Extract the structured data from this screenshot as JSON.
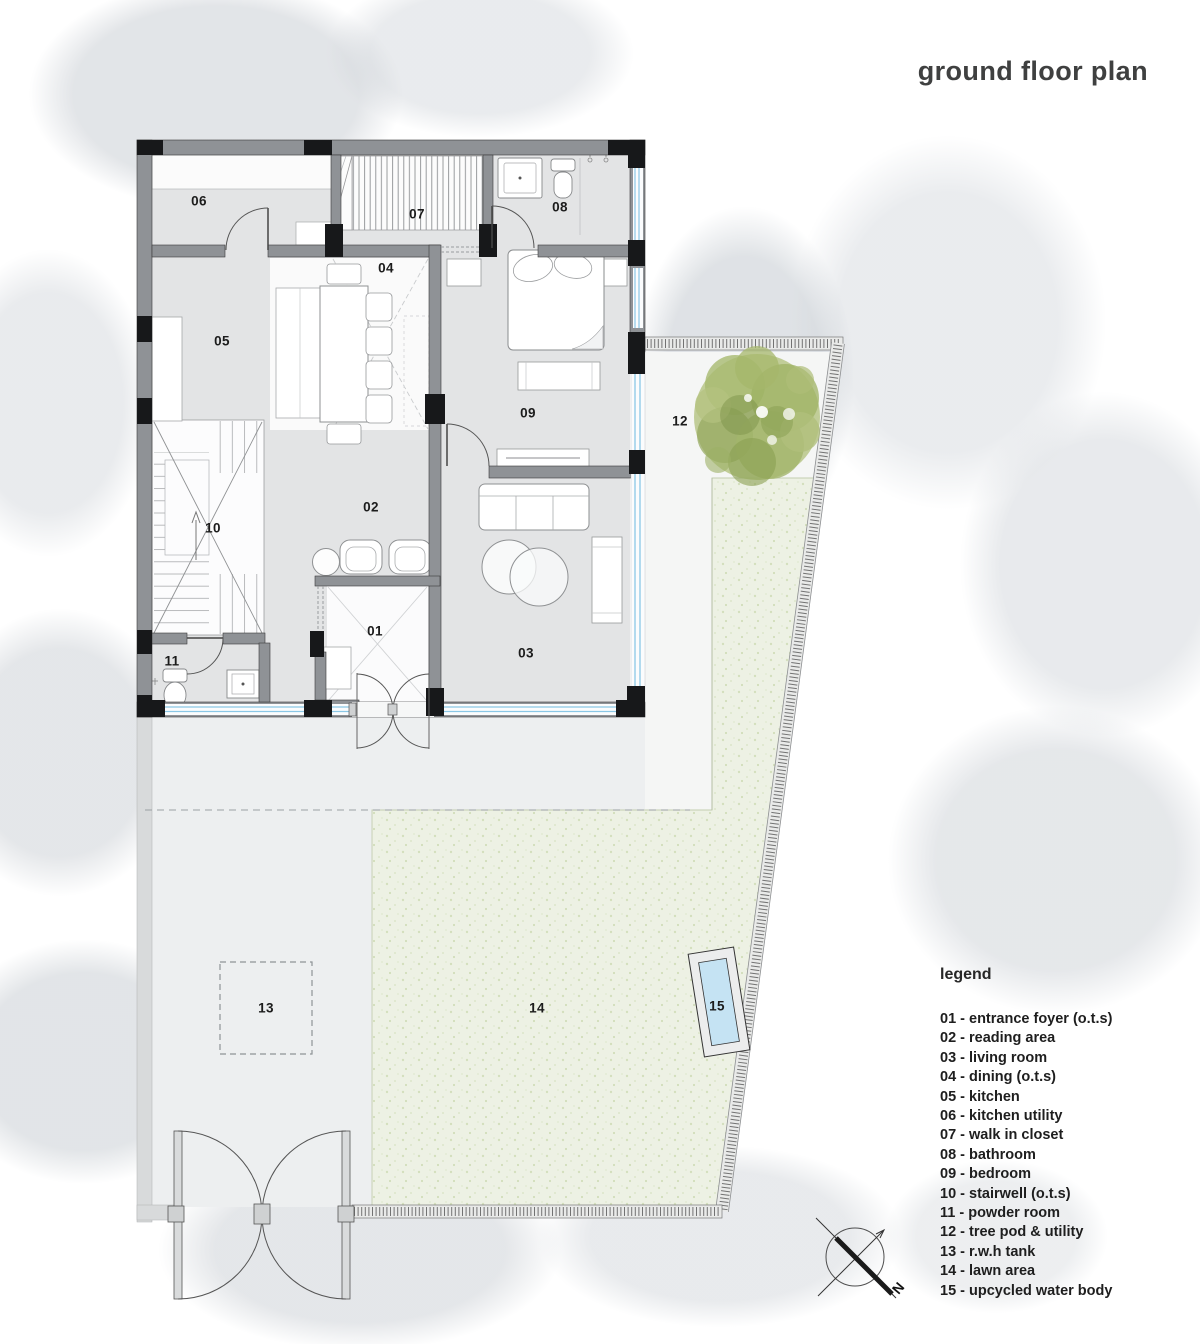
{
  "title": "ground floor plan",
  "legend": {
    "title": "legend",
    "items": [
      "01 - entrance foyer (o.t.s)",
      "02 - reading area",
      "03 - living room",
      "04 - dining (o.t.s)",
      "05 - kitchen",
      "06 - kitchen utility",
      "07 - walk in closet",
      "08 - bathroom",
      "09 - bedroom",
      "10 - stairwell (o.t.s)",
      "11 - powder room",
      "12 - tree pod & utility",
      "13 - r.w.h tank",
      "14 - lawn area",
      "15 - upcycled water body"
    ]
  },
  "plan": {
    "room_labels": {
      "r01": "01",
      "r02": "02",
      "r03": "03",
      "r04": "04",
      "r05": "05",
      "r06": "06",
      "r07": "07",
      "r08": "08",
      "r09": "09",
      "r10": "10",
      "r11": "11",
      "r12": "12",
      "r13": "13",
      "r14": "14",
      "r15": "15"
    }
  },
  "compass": {
    "north_label": "N"
  },
  "colors": {
    "wall_gray": "#8f9296",
    "column_black": "#17181a",
    "window_blue": "#8ac7e6",
    "pool_blue": "#c5e3f3",
    "lawn_green": "#edf1e4",
    "tree_green": "#a9bc72",
    "floor_gray": "#e3e4e5"
  }
}
